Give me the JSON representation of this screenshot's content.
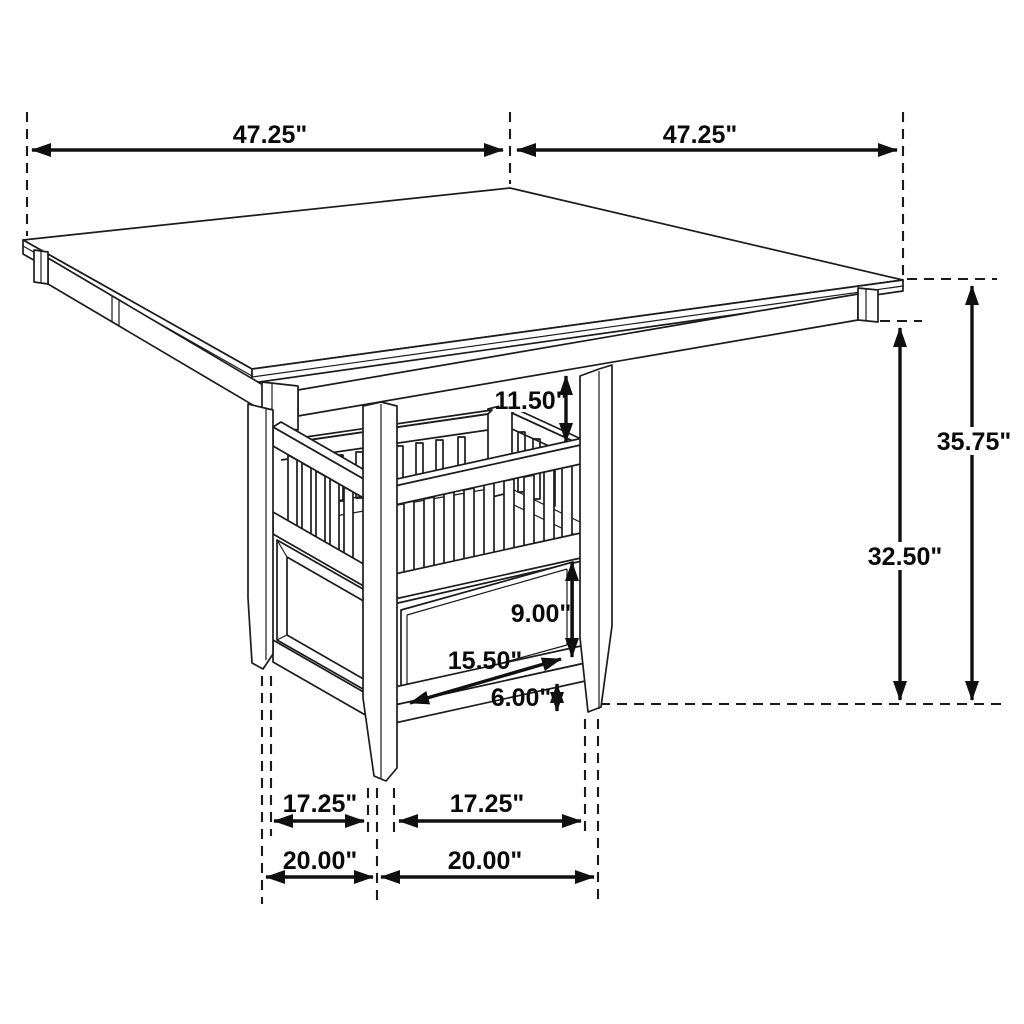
{
  "figure": {
    "title": "Counter-height square table dimension diagram",
    "product": "Square counter-height dining table with pedestal storage base (slat shelf and drawer)",
    "units": "inches",
    "view": "three-quarter isometric line drawing with dimension callouts"
  },
  "dims": {
    "top_width_left": "47.25\"",
    "top_width_right": "47.25\"",
    "overall_height": "35.75\"",
    "apron_clearance_height": "32.50\"",
    "shelf_opening_height": "11.50\"",
    "drawer_panel_height": "9.00\"",
    "drawer_panel_width": "15.50\"",
    "base_bottom_clearance": "6.00\"",
    "foot_span_inner_left": "17.25\"",
    "foot_span_inner_right": "17.25\"",
    "foot_span_outer_left": "20.00\"",
    "foot_span_outer_right": "20.00\""
  },
  "colors": {
    "line": "#1c1c1c",
    "dimension": "#101010",
    "background": "#ffffff",
    "text": "#0b0b0b"
  }
}
